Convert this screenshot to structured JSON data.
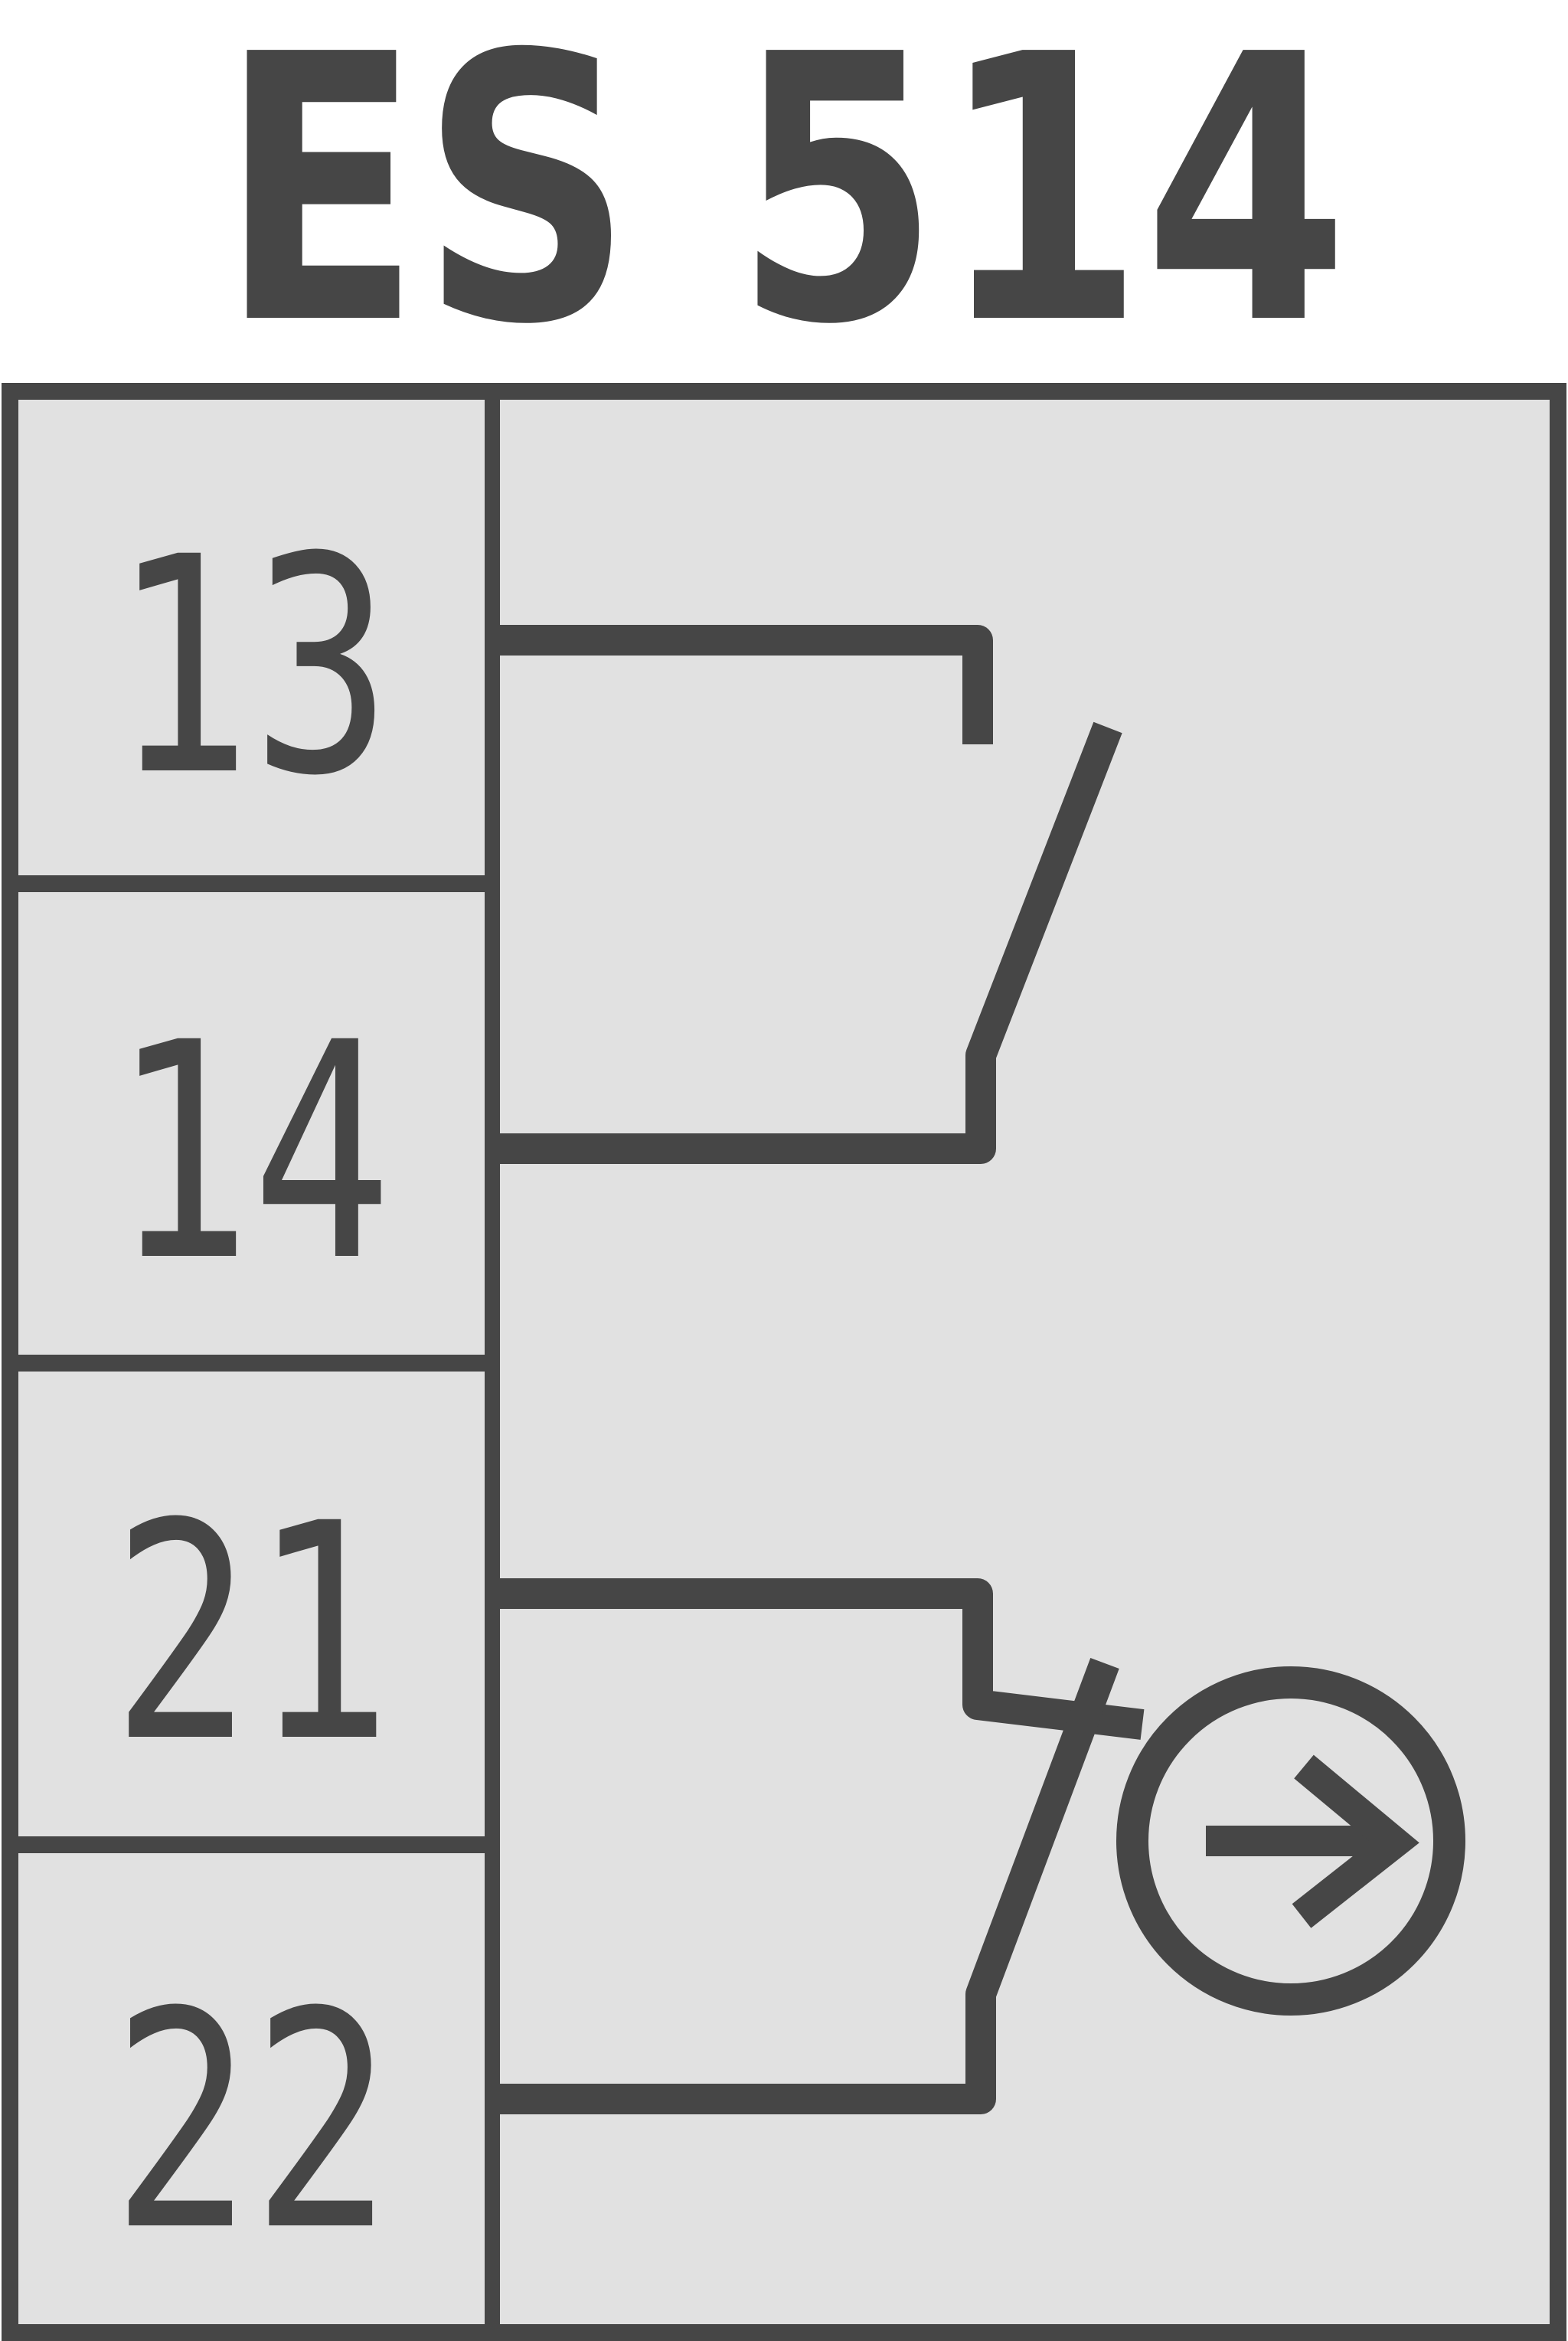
{
  "title": "ES 514",
  "panel": {
    "terminals": [
      {
        "label": "13"
      },
      {
        "label": "14"
      },
      {
        "label": "21"
      },
      {
        "label": "22"
      }
    ],
    "contacts": [
      {
        "name": "no-contact",
        "type": "normally-open",
        "between": [
          "13",
          "14"
        ]
      },
      {
        "name": "nc-contact",
        "type": "normally-closed",
        "between": [
          "21",
          "22"
        ]
      }
    ],
    "icons": [
      {
        "name": "actuation-direction-icon",
        "shape": "circle-with-right-arrow"
      }
    ]
  },
  "colors": {
    "line": "#464646",
    "panel_bg": "#e1e1e1",
    "page_bg": "#ffffff"
  }
}
